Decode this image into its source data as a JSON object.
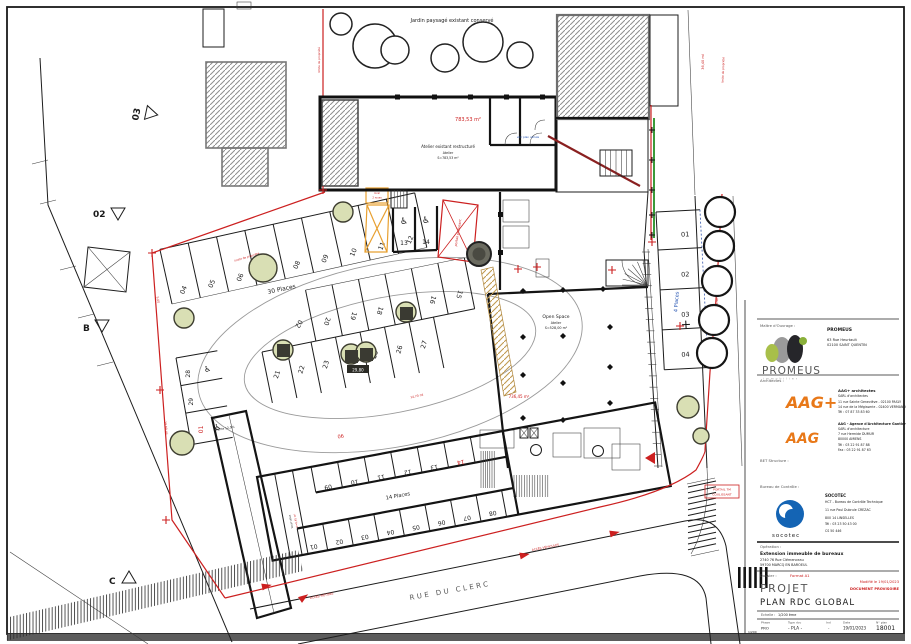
{
  "colors": {
    "red": "#cc2020",
    "morange": "#e8a030",
    "orange": "#e87818",
    "tree": "#d9dfb4",
    "blue": "#2050b0",
    "green": "#3a9a3a",
    "socotec": "#1464b4"
  },
  "plan": {
    "icons": {
      "wheelchair": "♿"
    },
    "garden_label": "Jardin paysagé existant conservé",
    "boundary_note_top": "limite de propriété",
    "boundary_note_right": "limite de propriété",
    "boundary_note_parking": "limite de propriété",
    "dim_right_top": "36,40 ml",
    "dim_right_mid": "24,90 ml",
    "dim_left_1": "5,00",
    "dim_left_2": "19,80 ml",
    "atelier": {
      "area_red": "783,53 m²",
      "l1": "Atelier existant restructuré",
      "l2": "Atelier",
      "l3": "S=783,53 m²",
      "note_blue": "voir plan cellule"
    },
    "open_space": {
      "l1": "Open Space",
      "l2": "Atelier",
      "l3": "S=528,00 m²",
      "area_red": "736,45 m²"
    },
    "parking30": {
      "label": "30 Places",
      "dim_red": "14,70 ml",
      "planter_dim": "29,80",
      "stall_02": "02",
      "row_top": [
        "04",
        "05",
        "06",
        "07",
        "08",
        "09",
        "10",
        "11",
        "12"
      ],
      "row_mid_upper": [
        "20",
        "19",
        "18",
        "17",
        "16",
        "15"
      ],
      "row_mid_lower": [
        "21",
        "22",
        "23",
        "24",
        "25",
        "26",
        "27"
      ],
      "handicap_top": [
        "13",
        "14"
      ],
      "handicap_left": [
        "28",
        "29"
      ],
      "handicap_left_red": "01"
    },
    "parking4": {
      "label": "4 Places",
      "stalls": [
        "01",
        "02",
        "03",
        "04"
      ]
    },
    "parking14": {
      "label": "14 Places",
      "row_upper": [
        "09",
        "10",
        "11",
        "12",
        "13"
      ],
      "row_upper_red": "14",
      "row_lower": [
        "01",
        "02",
        "03",
        "04",
        "05",
        "06",
        "07",
        "08"
      ],
      "gate_red": "06",
      "velo_label": "local vélos",
      "velo_area": "S=8,45 m²"
    },
    "ramp_label": "Pente 12,5%",
    "gate_x_label": "portail coulissant",
    "gate_box": {
      "l1": "PORTAIL 7M",
      "l2": "COULISSANT"
    },
    "local_box": {
      "l1": "local",
      "l2": "2 roues"
    },
    "street_label": "RUE DU CLERC",
    "access1": "ACCÈS PIÉTONS",
    "access2": "ACCÈS VÉHICULES",
    "markers": {
      "m03": "03",
      "m02": "02",
      "mB": "B",
      "mC": "C"
    }
  },
  "titleblock": {
    "client_label": "Maître d'Ouvrage :",
    "client_name": "PROMEUS",
    "client_addr1": "63 Rue Heurtault",
    "client_addr2": "02100 SAINT QUENTIN",
    "client_logo": "PROMEUS",
    "client_logo_sub": "immobilier",
    "architects_label": "Architectes :",
    "arch1_logo": "AAG+",
    "arch1_name": "AAG+ architectes",
    "arch1_l1": "SARL d'architectes",
    "arch1_l2": "11 rue Sainte Geneviève - 02100 PASLY",
    "arch1_l3": "14 rue de la Mégisserie - 02400 VERMAND",
    "arch1_l4": "Tél : 07 87 33 83 60",
    "arch2_logo": "AAG",
    "arch2_name": "AAG - Agence d'Architecture Gantier",
    "arch2_l1": "SARL d'architecture",
    "arch2_l2": "7 rue Hermide DUMUR",
    "arch2_l3": "80000 AMIENS",
    "arch2_l4": "Tél : 03 22 91 87 88",
    "arch2_l5": "Fax : 03 22 91 87 63",
    "bet_label": "BET Structure :",
    "control_label": "Bureau de Contrôle :",
    "control_logo": "socotec",
    "control_name": "SOCOTEC",
    "control_l1": "HCT - Bureau de Contrôle Technique",
    "control_l2": "11 rue Paul Dubrule CREZAC",
    "control_l3": "800 14 LINSELLES",
    "control_l4": "Tél : 03 23 50 43 00",
    "control_l5": "CS 50 446",
    "operation_label": "Opération :",
    "operation_name": "Extension immeuble de bureaux",
    "operation_addr1": "2740 76 Rue Clémenceau",
    "operation_addr2": "59700 MARCQ EN BAROEUL",
    "dossier_label": "Dossier :",
    "dossier_format_red": "Format A1",
    "phase_title": "PROJET",
    "note_red1": "Modifié le 19/01/2023",
    "note_red2": "DOCUMENT PROVISOIRE",
    "drawing_title": "PLAN RDC GLOBAL",
    "scale_label": "Echelle :",
    "scale_value": "1/200 ème",
    "corner_scale": "1/200",
    "t_phase_h": "Phase",
    "t_phase_v": "PRO",
    "t_type_h": "Type doc",
    "t_type_v": "- PLA -",
    "t_ind_h": "Ind",
    "t_ind_v": "-",
    "t_date_h": "Date",
    "t_date_v": "19/01/2023",
    "t_num_h": "N° plan",
    "t_num_v": "18001"
  }
}
